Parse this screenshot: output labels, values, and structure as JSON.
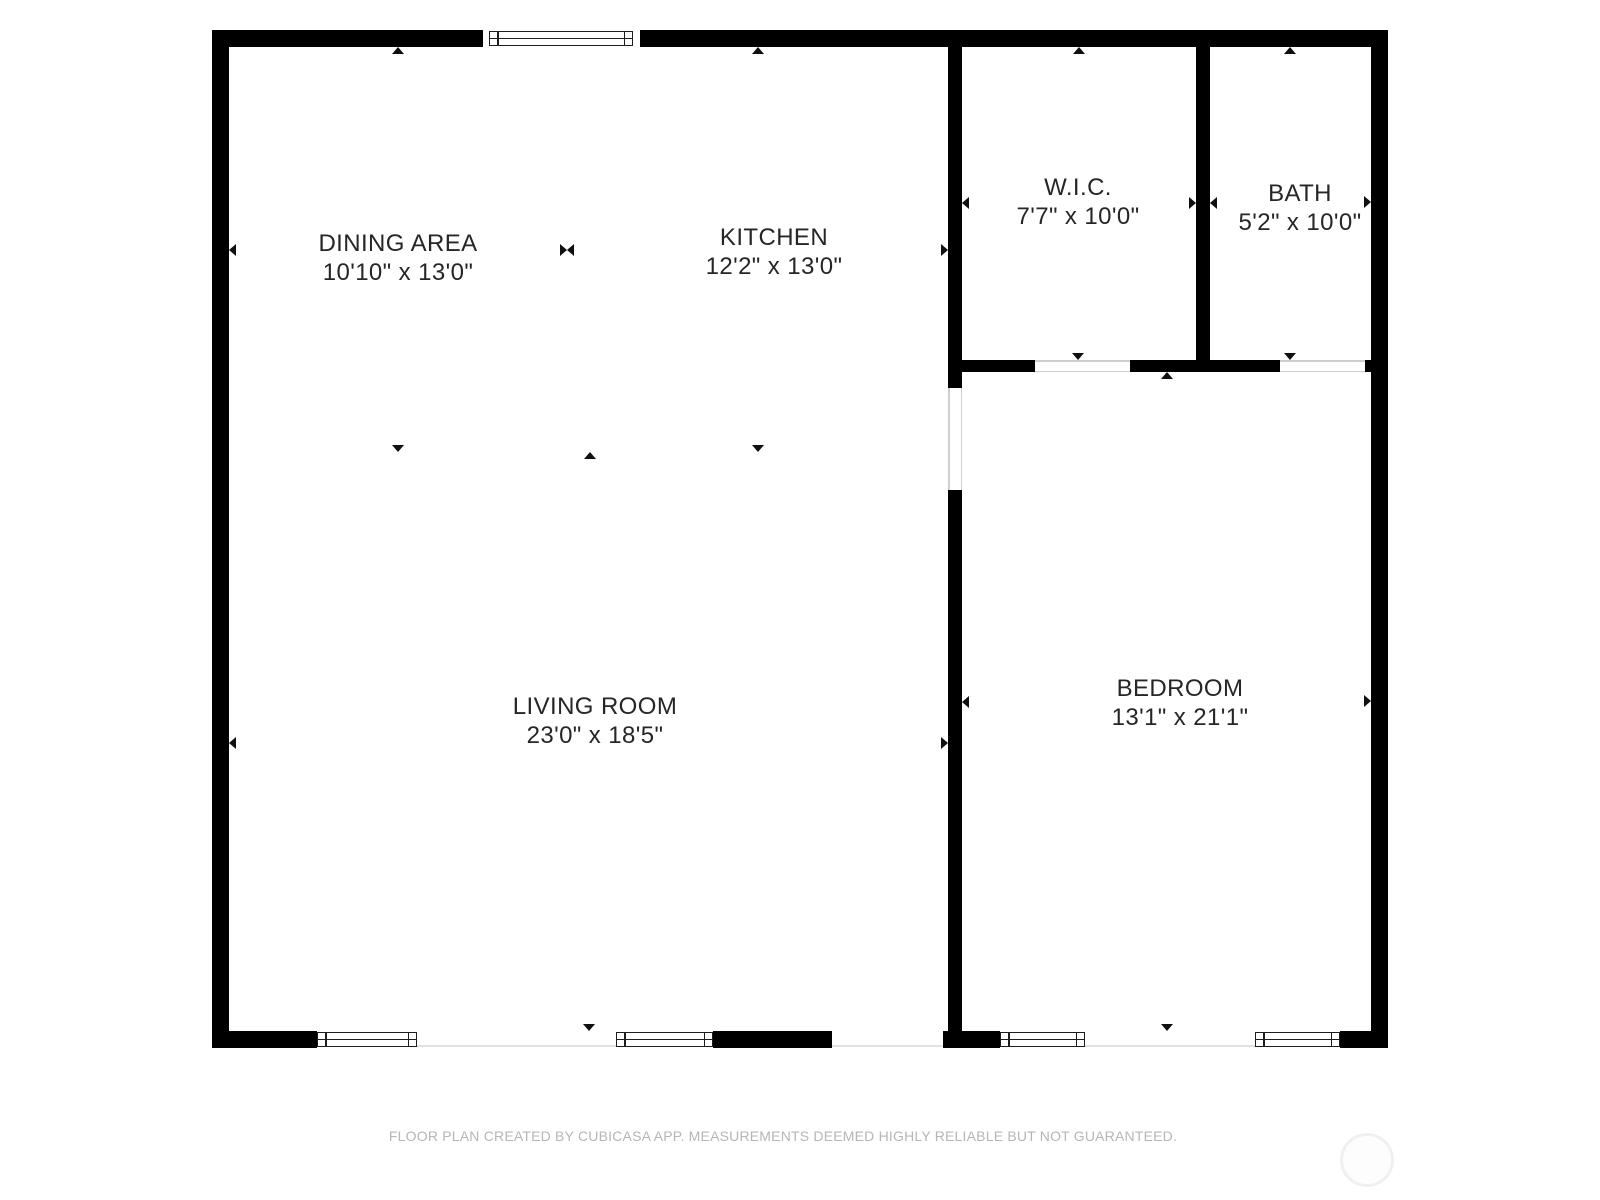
{
  "floorplan": {
    "rooms": [
      {
        "name": "DINING AREA",
        "dims": "10'10\" x 13'0\""
      },
      {
        "name": "KITCHEN",
        "dims": "12'2\" x 13'0\""
      },
      {
        "name": "W.I.C.",
        "dims": "7'7\" x 10'0\""
      },
      {
        "name": "BATH",
        "dims": "5'2\" x 10'0\""
      },
      {
        "name": "LIVING ROOM",
        "dims": "23'0\" x 18'5\""
      },
      {
        "name": "BEDROOM",
        "dims": "13'1\" x 21'1\""
      }
    ],
    "footer": "FLOOR PLAN CREATED BY CUBICASA APP. MEASUREMENTS DEEMED HIGHLY RELIABLE BUT NOT GUARANTEED.",
    "colors": {
      "wall": "#000000",
      "background": "#ffffff",
      "room_label": "#262626",
      "window_frame": "#1d1d1d",
      "opening_line": "#e2e2e2",
      "door_line": "#cfcfcf",
      "footer_text": "#b6b6b6",
      "logo_ring": "#f0f0f0"
    },
    "icons": {
      "arrow_up": "small solid triangle pointing up (opening marker)",
      "arrow_down": "small solid triangle pointing down (opening marker)",
      "arrow_left": "small solid triangle pointing left (opening marker)",
      "arrow_right": "small solid triangle pointing right (opening marker)",
      "bowtie": "two facing triangles marking open room boundary",
      "logo": "faint circular watermark"
    }
  }
}
